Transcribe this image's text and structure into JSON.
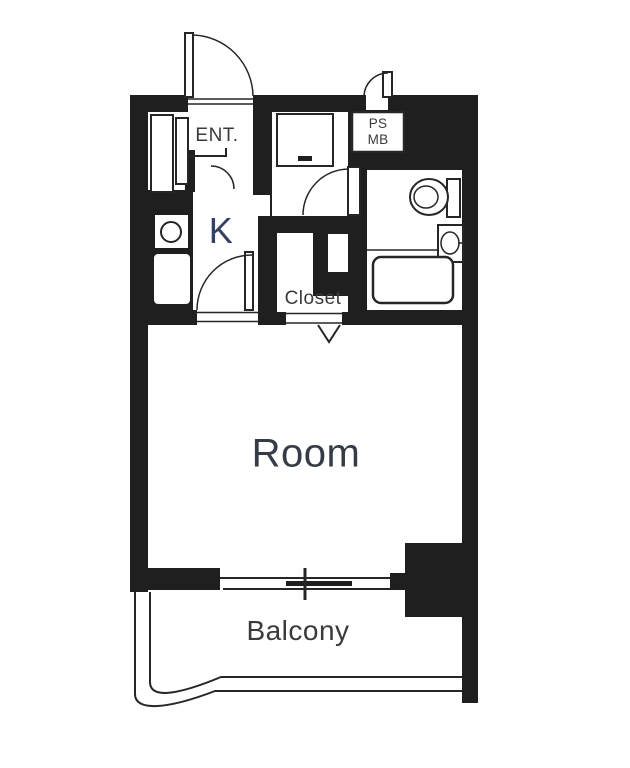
{
  "document": {
    "type": "apartment-floor-plan"
  },
  "rooms": {
    "entrance_label": "ENT.",
    "pipe_space_label_line1": "PS",
    "pipe_space_label_line2": "MB",
    "kitchen_label": "K",
    "closet_label": "Closet",
    "room_label": "Room",
    "balcony_label": "Balcony"
  },
  "colors": {
    "wall": "#1f1f1f",
    "line": "#262626",
    "label": "#3a3a3a",
    "kitchen_label_color": "#344065",
    "room_label_color": "#363c46",
    "background": "#ffffff"
  }
}
